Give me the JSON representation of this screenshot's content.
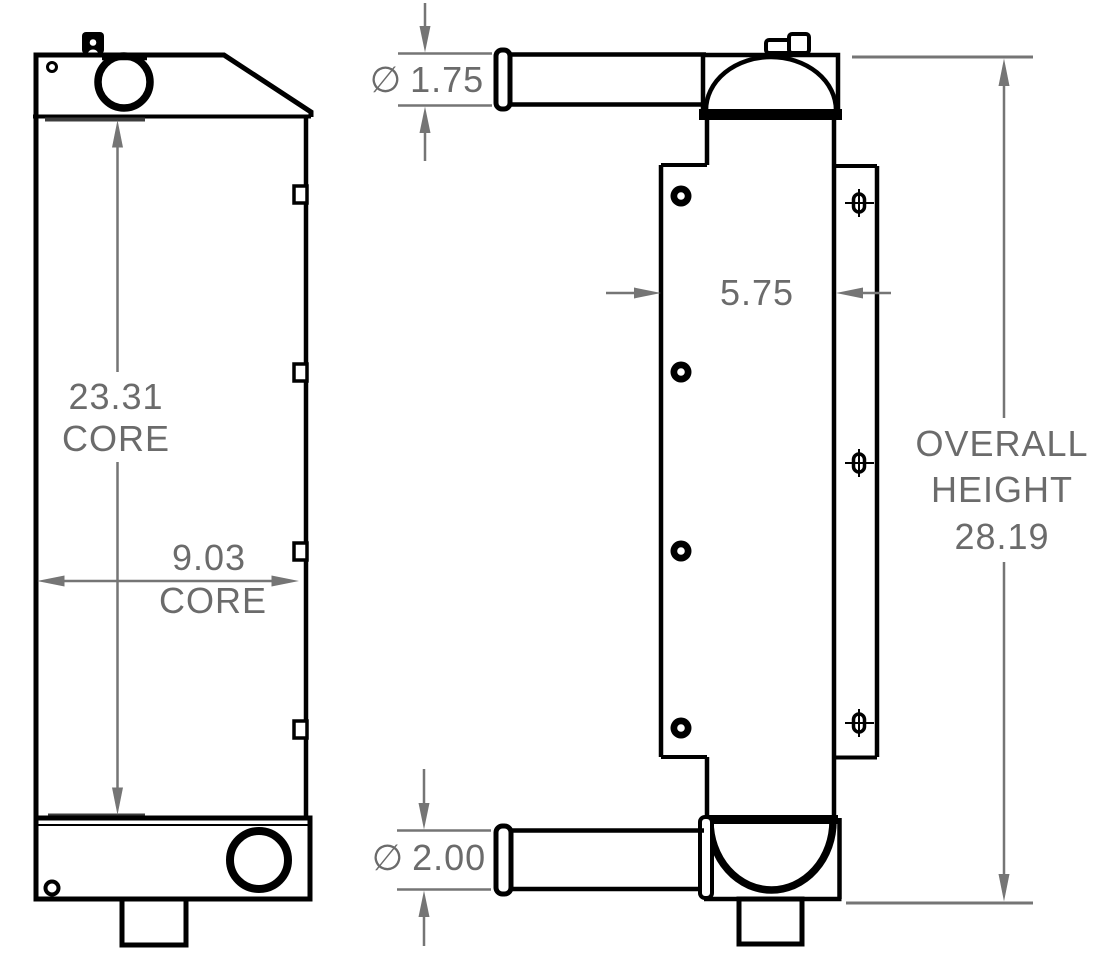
{
  "drawing": {
    "type": "radiator technical drawing, front and side orthographic views"
  },
  "colors": {
    "outline": "#000000",
    "dimension_line": "#757575",
    "dimension_text": "#6b6b6b",
    "core_mark": "#3d3d3d",
    "background": "#ffffff"
  },
  "dimensions": {
    "core_height": {
      "value": "23.31",
      "label": "CORE"
    },
    "core_width": {
      "value": "9.03",
      "label": "CORE"
    },
    "inlet_diameter": {
      "symbol": "∅",
      "value": "1.75"
    },
    "outlet_diameter": {
      "symbol": "∅",
      "value": "2.00"
    },
    "depth": {
      "value": "5.75"
    },
    "overall_height": {
      "word1": "OVERALL",
      "word2": "HEIGHT",
      "value": "28.19"
    }
  }
}
